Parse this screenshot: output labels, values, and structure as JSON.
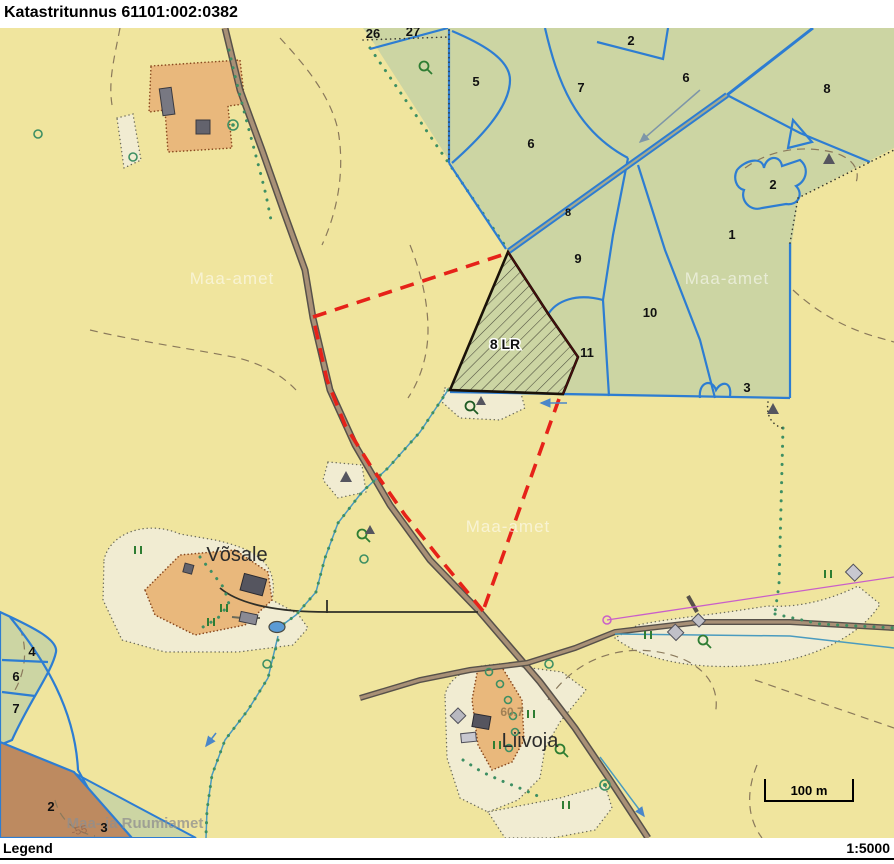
{
  "title": "Katastritunnus 61101:002:0382",
  "footer": {
    "legend": "Legend",
    "scale": "1:5000"
  },
  "map": {
    "scale_bar": "100 m",
    "target_parcel_label": "8 LR",
    "elevation_label": "60.7",
    "contour_label": "-55",
    "places": {
      "vosale": "Võsale",
      "liivoja": "Liivoja"
    },
    "watermarks": {
      "w1": "Maa-amet",
      "w2": "Maa-amet",
      "w3": "Maa-amet",
      "w4": "Maa- ja Ruumiamet"
    },
    "parcels": [
      {
        "label": "26",
        "x": 373,
        "y": 38
      },
      {
        "label": "27",
        "x": 413,
        "y": 36
      },
      {
        "label": "2",
        "x": 631,
        "y": 45
      },
      {
        "label": "5",
        "x": 476,
        "y": 86
      },
      {
        "label": "7",
        "x": 581,
        "y": 92
      },
      {
        "label": "6",
        "x": 686,
        "y": 82
      },
      {
        "label": "8",
        "x": 827,
        "y": 93
      },
      {
        "label": "6",
        "x": 531,
        "y": 148
      },
      {
        "label": "2",
        "x": 773,
        "y": 189
      },
      {
        "label": "1",
        "x": 732,
        "y": 239
      },
      {
        "label": "8",
        "x": 568,
        "y": 216,
        "small": true
      },
      {
        "label": "9",
        "x": 578,
        "y": 263
      },
      {
        "label": "10",
        "x": 650,
        "y": 317
      },
      {
        "label": "11",
        "x": 587,
        "y": 357
      },
      {
        "label": "3",
        "x": 747,
        "y": 392
      },
      {
        "label": "4",
        "x": 32,
        "y": 656
      },
      {
        "label": "6",
        "x": 16,
        "y": 681
      },
      {
        "label": "7",
        "x": 16,
        "y": 713
      },
      {
        "label": "2",
        "x": 51,
        "y": 811
      },
      {
        "label": "3",
        "x": 104,
        "y": 832
      }
    ],
    "colors": {
      "background": "#f0e59e",
      "forest": "#ccd5a3",
      "farmstead": "#e9b87c",
      "open_area": "#f1ecd2",
      "brown_parcel": "#bd8a60",
      "cadastral_blue": "#2d7dd2",
      "target_outline": "#1a1208",
      "selection_red": "#e62219",
      "road": "#a89076",
      "tree_green": "#3d8f63",
      "powerline_magenta": "#c95fc9"
    }
  }
}
